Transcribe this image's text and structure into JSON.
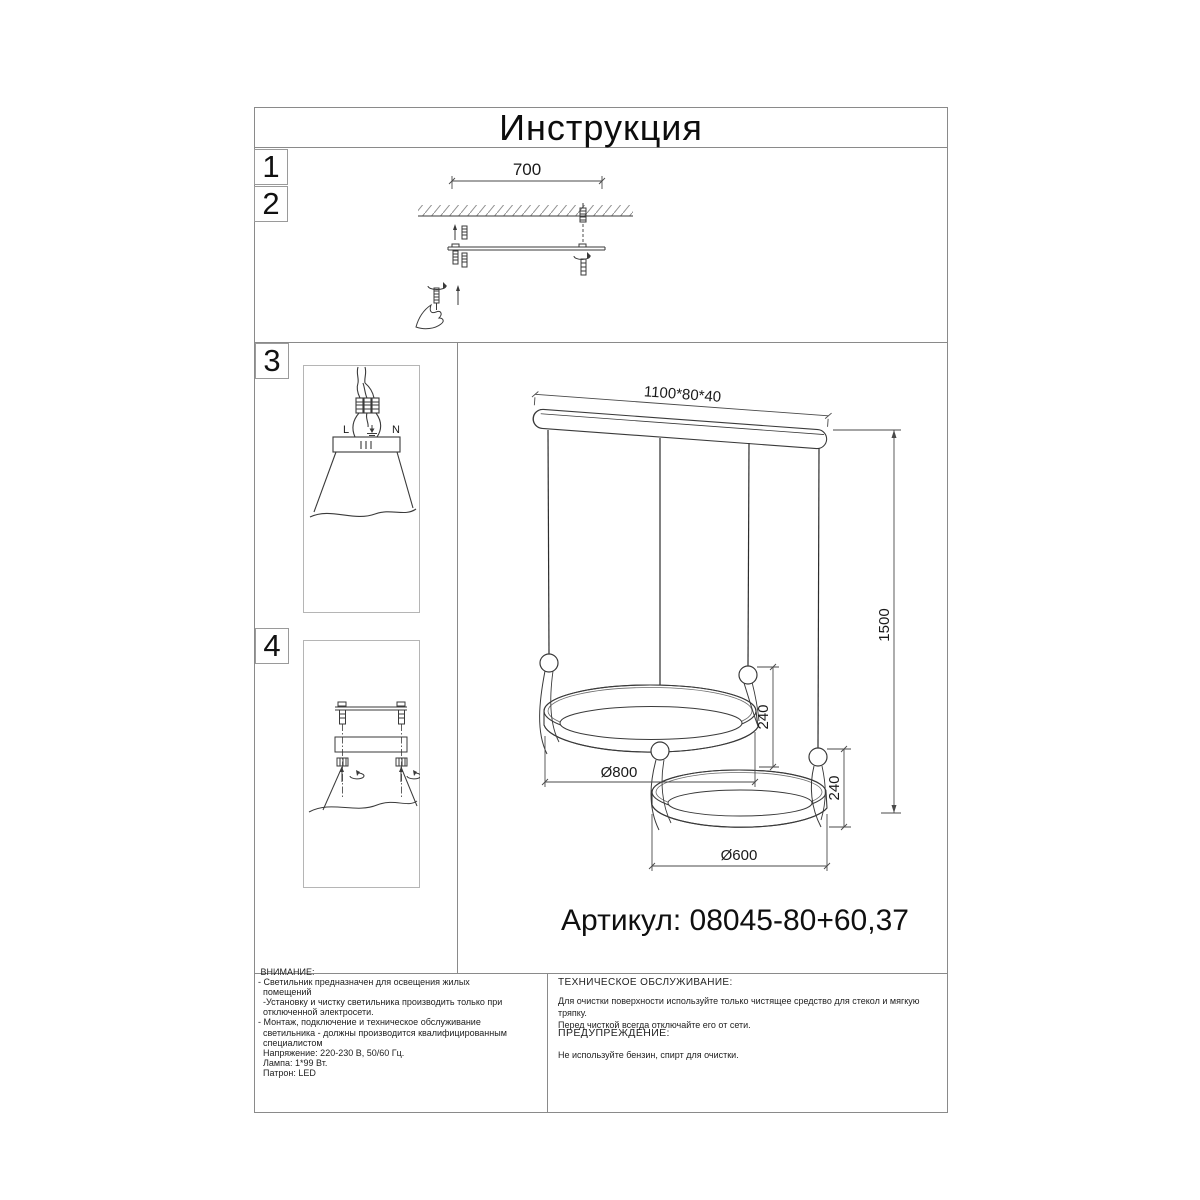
{
  "page": {
    "title": "Инструкция",
    "article": "Артикул: 08045-80+60,37"
  },
  "steps": [
    {
      "num": "1"
    },
    {
      "num": "2"
    },
    {
      "num": "3"
    },
    {
      "num": "4"
    }
  ],
  "dims": {
    "bracket_span": "700",
    "canopy": "1100*80*40",
    "drop": "1500",
    "ring1_d": "Ø800",
    "ring1_h": "240",
    "ring2_d": "Ø600",
    "ring2_h": "240"
  },
  "wiring": {
    "live": "L",
    "neutral": "N"
  },
  "notes": {
    "attention_text": " ВНИМАНИЕ:\n- Светильник предназначен для освещения жилых\n  помещений\n  -Установку и чистку светильника производить только при\n  отключенной электросети.\n- Монтаж, подключение и техническое обслуживание\n  светильника - должны производится квалифицированным\n  специалистом\n  Напряжение: 220-230 В, 50/60 Гц.\n  Лампа: 1*99 Вт.\n  Патрон: LED",
    "maintenance_heading": "ТЕХНИЧЕСКОЕ ОБСЛУЖИВАНИЕ:",
    "maintenance_body": "Для очистки поверхности используйте только чистящее средство для стекол и мягкую тряпку.\nПеред чисткой всегда отключайте его от сети.",
    "warning_heading": "ПРЕДУПРЕЖДЕНИЕ:",
    "warning_body": "Не используйте бензин, спирт для очистки."
  },
  "colors": {
    "line": "#3a3a3a",
    "dim_line": "#4a4a4a",
    "border": "#8a8a8a"
  }
}
